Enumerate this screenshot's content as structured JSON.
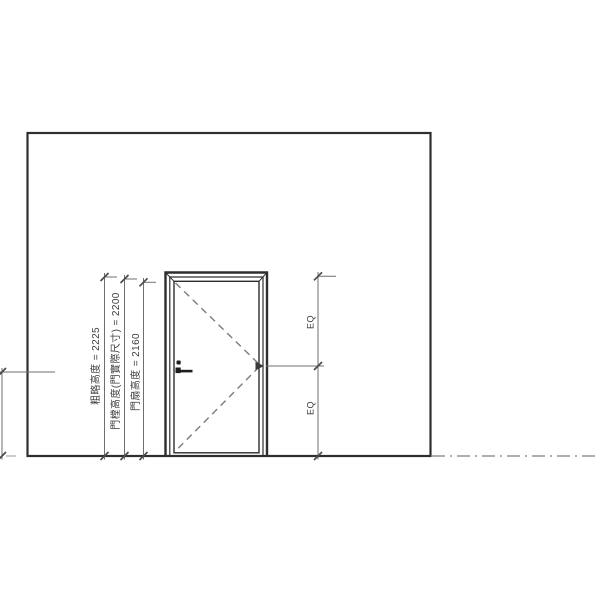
{
  "palette": {
    "model": "#2e2e2e",
    "dim": "#6f6f6f",
    "swing": "#7c7c7c",
    "level": "#949494",
    "txt": "#3c3c3c",
    "bg": "#ffffff"
  },
  "drawing": {
    "left_dimensions": [
      {
        "label": "粗略高度 = 2225",
        "value_mm": 2225
      },
      {
        "label": "門樘高度(門實際尺寸) = 2200",
        "value_mm": 2200
      },
      {
        "label": "門扇高度 = 2160",
        "value_mm": 2160
      }
    ],
    "right_dimension": {
      "upper_label": "EQ",
      "lower_label": "EQ"
    }
  }
}
